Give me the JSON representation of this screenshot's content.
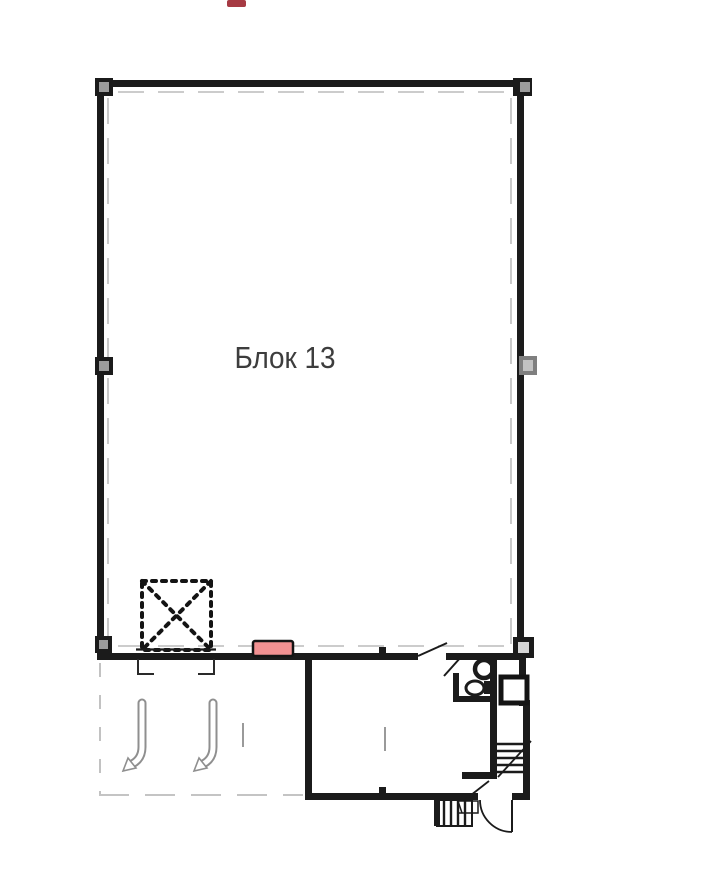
{
  "page": {
    "background": "#ffffff"
  },
  "plan": {
    "block_label": "Блок 13",
    "colors": {
      "wall": "#1b1b1b",
      "inset_dash": "#bcbcbc",
      "gray_symbol": "#8f8f8f",
      "column_fill_dark": "#9c9c9c",
      "column_fill_light": "#d6d6d6",
      "column_gray_outer": "#7f7f7f",
      "column_gray_inner": "#c2c2c2",
      "highlight_fill": "#f29192",
      "highlight_stroke": "#141414",
      "top_mark_fill": "#a63a43",
      "label_color": "#3d3d3d"
    }
  }
}
